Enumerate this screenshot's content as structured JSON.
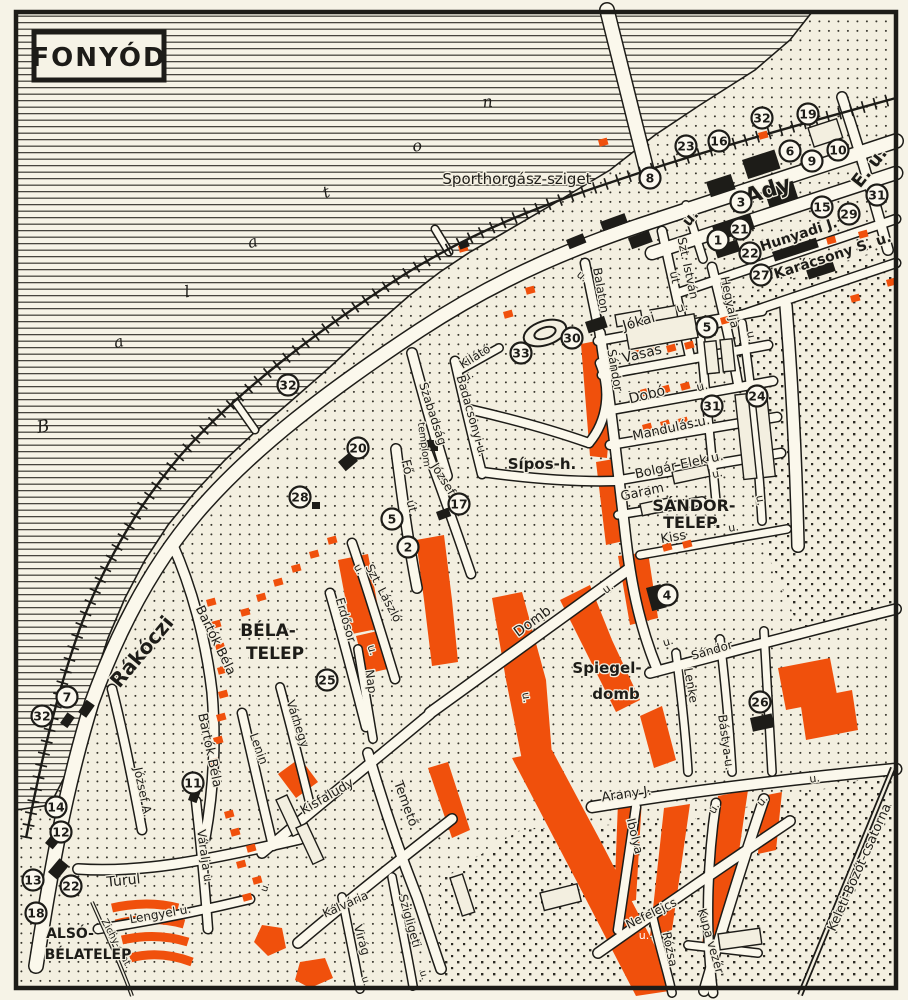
{
  "title": "FONYÓD",
  "colors": {
    "paper": "#f3efe0",
    "ink": "#1d1c18",
    "orange": "#f0500c",
    "road": "#fbf8ec"
  },
  "water_name_letters": [
    {
      "text": "B",
      "x": 44,
      "y": 432,
      "rot": -10,
      "size": 17,
      "italic": true
    },
    {
      "text": "a",
      "x": 120,
      "y": 347,
      "rot": -15,
      "size": 16,
      "italic": true
    },
    {
      "text": "l",
      "x": 188,
      "y": 297,
      "rot": -10,
      "size": 16,
      "italic": true
    },
    {
      "text": "a",
      "x": 254,
      "y": 247,
      "rot": -15,
      "size": 16,
      "italic": true
    },
    {
      "text": "t",
      "x": 328,
      "y": 197,
      "rot": -20,
      "size": 16,
      "italic": true
    },
    {
      "text": "o",
      "x": 418,
      "y": 151,
      "rot": -10,
      "size": 16,
      "italic": true
    },
    {
      "text": "n",
      "x": 488,
      "y": 107,
      "rot": -5,
      "size": 16,
      "italic": true
    }
  ],
  "labels": [
    {
      "text": "Sporthorgász-sziget",
      "x": 517,
      "y": 184,
      "rot": 0,
      "size": 15
    },
    {
      "text": "Ady",
      "x": 770,
      "y": 197,
      "rot": -18,
      "size": 22,
      "bold": true
    },
    {
      "text": "E. u.",
      "x": 874,
      "y": 171,
      "rot": -52,
      "size": 18,
      "bold": true
    },
    {
      "text": "u.",
      "x": 694,
      "y": 221,
      "rot": -50,
      "size": 15,
      "bold": true
    },
    {
      "text": "Hunyadi J.",
      "x": 800,
      "y": 239,
      "rot": -18,
      "size": 14,
      "bold": true
    },
    {
      "text": "Karácsony S. u.",
      "x": 834,
      "y": 260,
      "rot": -18,
      "size": 14,
      "bold": true
    },
    {
      "text": "Szt. István",
      "x": 684,
      "y": 269,
      "rot": 78,
      "size": 12
    },
    {
      "text": "út",
      "x": 671,
      "y": 278,
      "rot": 78,
      "size": 12
    },
    {
      "text": "Hegyalja",
      "x": 726,
      "y": 303,
      "rot": 78,
      "size": 12
    },
    {
      "text": "u.",
      "x": 748,
      "y": 337,
      "rot": 78,
      "size": 11
    },
    {
      "text": "Balaton",
      "x": 597,
      "y": 291,
      "rot": 80,
      "size": 12
    },
    {
      "text": "u.",
      "x": 580,
      "y": 279,
      "rot": 40,
      "size": 11
    },
    {
      "text": "Jókai",
      "x": 640,
      "y": 326,
      "rot": -16,
      "size": 14
    },
    {
      "text": "u.",
      "x": 683,
      "y": 311,
      "rot": -16,
      "size": 12
    },
    {
      "text": "Vasas",
      "x": 643,
      "y": 358,
      "rot": -14,
      "size": 14
    },
    {
      "text": "Dobó",
      "x": 648,
      "y": 399,
      "rot": -14,
      "size": 14
    },
    {
      "text": "u.",
      "x": 703,
      "y": 390,
      "rot": -14,
      "size": 12
    },
    {
      "text": "Mandulás u.",
      "x": 672,
      "y": 432,
      "rot": -12,
      "size": 13
    },
    {
      "text": "Bolgár Elek u.",
      "x": 680,
      "y": 469,
      "rot": -12,
      "size": 13
    },
    {
      "text": "Garam",
      "x": 643,
      "y": 496,
      "rot": -12,
      "size": 13
    },
    {
      "text": "SÁNDOR-",
      "x": 694,
      "y": 511,
      "rot": 0,
      "size": 16,
      "bold": true
    },
    {
      "text": "TELEP.",
      "x": 692,
      "y": 528,
      "rot": 0,
      "size": 16,
      "bold": true
    },
    {
      "text": "Kiss",
      "x": 674,
      "y": 541,
      "rot": -10,
      "size": 13
    },
    {
      "text": "u.",
      "x": 734,
      "y": 531,
      "rot": -10,
      "size": 11
    },
    {
      "text": "Sándor",
      "x": 611,
      "y": 371,
      "rot": 80,
      "size": 12
    },
    {
      "text": "Kilátó",
      "x": 477,
      "y": 360,
      "rot": -32,
      "size": 12
    },
    {
      "text": "u.",
      "x": 470,
      "y": 379,
      "rot": -32,
      "size": 11
    },
    {
      "text": "Badacsonyi u.",
      "x": 468,
      "y": 417,
      "rot": 74,
      "size": 12
    },
    {
      "text": "Szabadság",
      "x": 429,
      "y": 415,
      "rot": 72,
      "size": 12
    },
    {
      "text": "templom",
      "x": 421,
      "y": 445,
      "rot": 82,
      "size": 10
    },
    {
      "text": "Fő",
      "x": 403,
      "y": 468,
      "rot": 76,
      "size": 13
    },
    {
      "text": "út",
      "x": 408,
      "y": 507,
      "rot": 76,
      "size": 12
    },
    {
      "text": "József",
      "x": 440,
      "y": 481,
      "rot": 58,
      "size": 12
    },
    {
      "text": "Sípos-h.",
      "x": 542,
      "y": 469,
      "rot": 0,
      "size": 15,
      "bold": true
    },
    {
      "text": "Szt. László",
      "x": 380,
      "y": 595,
      "rot": 62,
      "size": 12
    },
    {
      "text": "u.",
      "x": 356,
      "y": 571,
      "rot": 62,
      "size": 11
    },
    {
      "text": "Erdősor",
      "x": 342,
      "y": 621,
      "rot": 74,
      "size": 12
    },
    {
      "text": "u.",
      "x": 369,
      "y": 651,
      "rot": 74,
      "size": 11
    },
    {
      "text": "Nap",
      "x": 367,
      "y": 682,
      "rot": 82,
      "size": 12
    },
    {
      "text": "BÉLA-",
      "x": 268,
      "y": 636,
      "rot": 0,
      "size": 17,
      "bold": true
    },
    {
      "text": "TELEP",
      "x": 275,
      "y": 659,
      "rot": 0,
      "size": 17,
      "bold": true
    },
    {
      "text": "Bartók Béla",
      "x": 212,
      "y": 642,
      "rot": 64,
      "size": 13
    },
    {
      "text": "Bartók Béla",
      "x": 206,
      "y": 751,
      "rot": 78,
      "size": 13
    },
    {
      "text": "Várhegy",
      "x": 294,
      "y": 725,
      "rot": 72,
      "size": 12
    },
    {
      "text": "Lenin",
      "x": 255,
      "y": 750,
      "rot": 70,
      "size": 12
    },
    {
      "text": "Domb",
      "x": 535,
      "y": 625,
      "rot": -36,
      "size": 14
    },
    {
      "text": "u.",
      "x": 523,
      "y": 698,
      "rot": 80,
      "size": 11
    },
    {
      "text": "u.",
      "x": 610,
      "y": 591,
      "rot": -36,
      "size": 11
    },
    {
      "text": "Spiegel-",
      "x": 607,
      "y": 673,
      "rot": 0,
      "size": 15,
      "bold": true
    },
    {
      "text": "domb",
      "x": 616,
      "y": 699,
      "rot": 0,
      "size": 15,
      "bold": true
    },
    {
      "text": "Lenke",
      "x": 687,
      "y": 686,
      "rot": 80,
      "size": 12
    },
    {
      "text": "Sándor",
      "x": 713,
      "y": 654,
      "rot": -16,
      "size": 12
    },
    {
      "text": "Bástya u.",
      "x": 722,
      "y": 743,
      "rot": 82,
      "size": 12
    },
    {
      "text": "u.",
      "x": 669,
      "y": 645,
      "rot": -16,
      "size": 11
    },
    {
      "text": "u.",
      "x": 757,
      "y": 501,
      "rot": 80,
      "size": 11
    },
    {
      "text": "u.",
      "x": 718,
      "y": 477,
      "rot": -12,
      "size": 11
    },
    {
      "text": "Rákóczi",
      "x": 147,
      "y": 656,
      "rot": -50,
      "size": 20,
      "bold": true
    },
    {
      "text": "József A.",
      "x": 139,
      "y": 793,
      "rot": 78,
      "size": 12
    },
    {
      "text": "Váralja u.",
      "x": 201,
      "y": 858,
      "rot": 82,
      "size": 12
    },
    {
      "text": "Turul",
      "x": 124,
      "y": 885,
      "rot": -6,
      "size": 14
    },
    {
      "text": "Lengyel u.",
      "x": 161,
      "y": 918,
      "rot": -10,
      "size": 12
    },
    {
      "text": "Zichy-csat.",
      "x": 114,
      "y": 945,
      "rot": 62,
      "size": 10
    },
    {
      "text": "ALSÓ-",
      "x": 70,
      "y": 938,
      "rot": 0,
      "size": 14,
      "bold": true
    },
    {
      "text": "BÉLATELEP",
      "x": 88,
      "y": 959,
      "rot": 0,
      "size": 14,
      "bold": true
    },
    {
      "text": "Kisfaludy",
      "x": 329,
      "y": 800,
      "rot": -30,
      "size": 13
    },
    {
      "text": "Temető",
      "x": 402,
      "y": 805,
      "rot": 70,
      "size": 13
    },
    {
      "text": "Kálvária",
      "x": 347,
      "y": 908,
      "rot": -24,
      "size": 12
    },
    {
      "text": "Virág",
      "x": 358,
      "y": 941,
      "rot": 74,
      "size": 12
    },
    {
      "text": "u.",
      "x": 363,
      "y": 982,
      "rot": 74,
      "size": 10
    },
    {
      "text": "Szigligeti",
      "x": 406,
      "y": 922,
      "rot": 74,
      "size": 12
    },
    {
      "text": "u.",
      "x": 421,
      "y": 976,
      "rot": 74,
      "size": 10
    },
    {
      "text": "u.",
      "x": 268,
      "y": 888,
      "rot": -70,
      "size": 10
    },
    {
      "text": "Arany J.",
      "x": 627,
      "y": 798,
      "rot": -8,
      "size": 13
    },
    {
      "text": "Ibolya",
      "x": 631,
      "y": 837,
      "rot": 76,
      "size": 12
    },
    {
      "text": "Nefelejcs",
      "x": 653,
      "y": 917,
      "rot": -26,
      "size": 12
    },
    {
      "text": "Rózsa",
      "x": 666,
      "y": 950,
      "rot": 78,
      "size": 12
    },
    {
      "text": "Kupa vezér",
      "x": 707,
      "y": 942,
      "rot": 74,
      "size": 12
    },
    {
      "text": "Keleti-Bozót-csatorna",
      "x": 863,
      "y": 869,
      "rot": -66,
      "size": 13
    },
    {
      "text": "u.",
      "x": 815,
      "y": 782,
      "rot": -8,
      "size": 11
    },
    {
      "text": "u.",
      "x": 765,
      "y": 803,
      "rot": -50,
      "size": 11
    },
    {
      "text": "u.",
      "x": 717,
      "y": 810,
      "rot": -60,
      "size": 11
    },
    {
      "text": "u.",
      "x": 644,
      "y": 939,
      "rot": 0,
      "size": 11,
      "white": true
    }
  ],
  "markers": [
    {
      "n": "32",
      "x": 762,
      "y": 118
    },
    {
      "n": "19",
      "x": 808,
      "y": 114
    },
    {
      "n": "23",
      "x": 686,
      "y": 146
    },
    {
      "n": "16",
      "x": 719,
      "y": 141
    },
    {
      "n": "6",
      "x": 790,
      "y": 151
    },
    {
      "n": "9",
      "x": 812,
      "y": 161
    },
    {
      "n": "10",
      "x": 838,
      "y": 150
    },
    {
      "n": "8",
      "x": 650,
      "y": 178
    },
    {
      "n": "3",
      "x": 741,
      "y": 202
    },
    {
      "n": "15",
      "x": 822,
      "y": 207
    },
    {
      "n": "29",
      "x": 849,
      "y": 214
    },
    {
      "n": "31",
      "x": 877,
      "y": 195
    },
    {
      "n": "21",
      "x": 740,
      "y": 229
    },
    {
      "n": "1",
      "x": 718,
      "y": 240
    },
    {
      "n": "22",
      "x": 750,
      "y": 253
    },
    {
      "n": "27",
      "x": 761,
      "y": 275
    },
    {
      "n": "5",
      "x": 707,
      "y": 327
    },
    {
      "n": "30",
      "x": 572,
      "y": 338
    },
    {
      "n": "33",
      "x": 521,
      "y": 353
    },
    {
      "n": "32",
      "x": 288,
      "y": 385
    },
    {
      "n": "20",
      "x": 358,
      "y": 448
    },
    {
      "n": "28",
      "x": 300,
      "y": 497
    },
    {
      "n": "24",
      "x": 757,
      "y": 396
    },
    {
      "n": "31",
      "x": 712,
      "y": 406
    },
    {
      "n": "17",
      "x": 459,
      "y": 504
    },
    {
      "n": "5",
      "x": 392,
      "y": 519
    },
    {
      "n": "2",
      "x": 408,
      "y": 547
    },
    {
      "n": "4",
      "x": 667,
      "y": 595
    },
    {
      "n": "25",
      "x": 327,
      "y": 680
    },
    {
      "n": "26",
      "x": 760,
      "y": 702
    },
    {
      "n": "7",
      "x": 67,
      "y": 697
    },
    {
      "n": "32",
      "x": 42,
      "y": 716
    },
    {
      "n": "14",
      "x": 56,
      "y": 807
    },
    {
      "n": "12",
      "x": 61,
      "y": 832
    },
    {
      "n": "11",
      "x": 193,
      "y": 783
    },
    {
      "n": "13",
      "x": 33,
      "y": 880
    },
    {
      "n": "22",
      "x": 71,
      "y": 886
    },
    {
      "n": "18",
      "x": 36,
      "y": 913
    }
  ]
}
